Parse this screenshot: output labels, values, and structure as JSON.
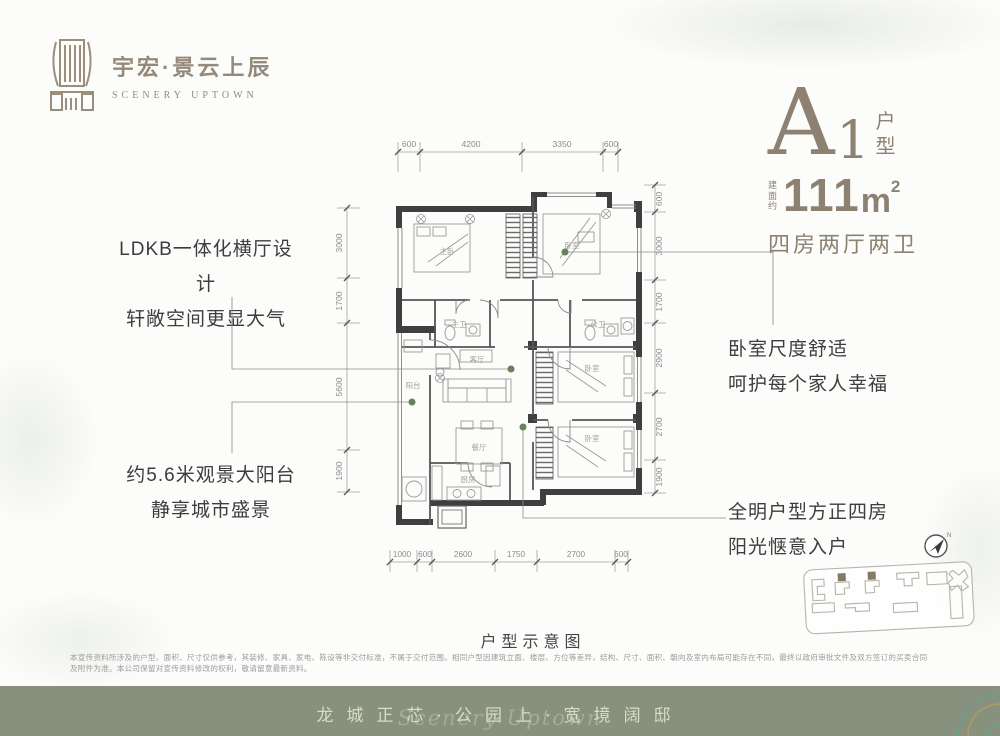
{
  "logo": {
    "name_cn": "宇宏·景云上辰",
    "name_en": "SCENERY UPTOWN"
  },
  "unit": {
    "letter": "A",
    "number": "1",
    "type": "户型",
    "area_prefix": "建面约",
    "area_value": "111",
    "area_unit": "m",
    "area_sup": "2",
    "rooms": "四房两厅两卫"
  },
  "annotations": {
    "left_top_1": "LDKB一体化横厅设计",
    "left_top_2": "轩敞空间更显大气",
    "left_bottom_1": "约5.6米观景大阳台",
    "left_bottom_2": "静享城市盛景",
    "right_top_1": "卧室尺度舒适",
    "right_top_2": "呵护每个家人幸福",
    "right_bottom_1": "全明户型方正四房",
    "right_bottom_2": "阳光惬意入户"
  },
  "plan": {
    "caption": "户型示意图",
    "rooms": {
      "master": "主卧",
      "bed_top": "卧室",
      "bed_mid": "卧室",
      "bed_bottom": "卧室",
      "living": "客厅",
      "dining": "餐厅",
      "kitchen": "厨房",
      "balcony": "阳台",
      "bath_master": "主卫",
      "bath_public": "公卫"
    },
    "dims_top": [
      "600",
      "4200",
      "3350",
      "600"
    ],
    "dims_bottom": [
      "1000",
      "600",
      "2600",
      "1750",
      "2700",
      "600"
    ],
    "dims_left": [
      "3000",
      "1700",
      "5600",
      "1900"
    ],
    "dims_right": [
      "600",
      "3000",
      "1700",
      "2900",
      "2700",
      "1900"
    ]
  },
  "compass": {
    "label": "N"
  },
  "disclaimer": "本宣传资料所涉及的户型、面积、尺寸仅供参考，其装修、家具、家电、陈设等非交付标准，不属于交付范围。相同户型因建筑立面、楼层、方位等差异，结构、尺寸、面积、朝向及室内布局可能存在不同，最终以政府审批文件及双方签订的买卖合同及附件为准。本公司保留对宣传资料修改的权利，敬请留意最新资料。",
  "banner": {
    "slogan": "龙城正芯·公园上·宽境阔邸",
    "script": "Scenery Uptown"
  },
  "colors": {
    "accent": "#8d8172",
    "wall": "#3f3f3f",
    "leader_dot": "#68805e",
    "banner_bg": "#87917d"
  }
}
